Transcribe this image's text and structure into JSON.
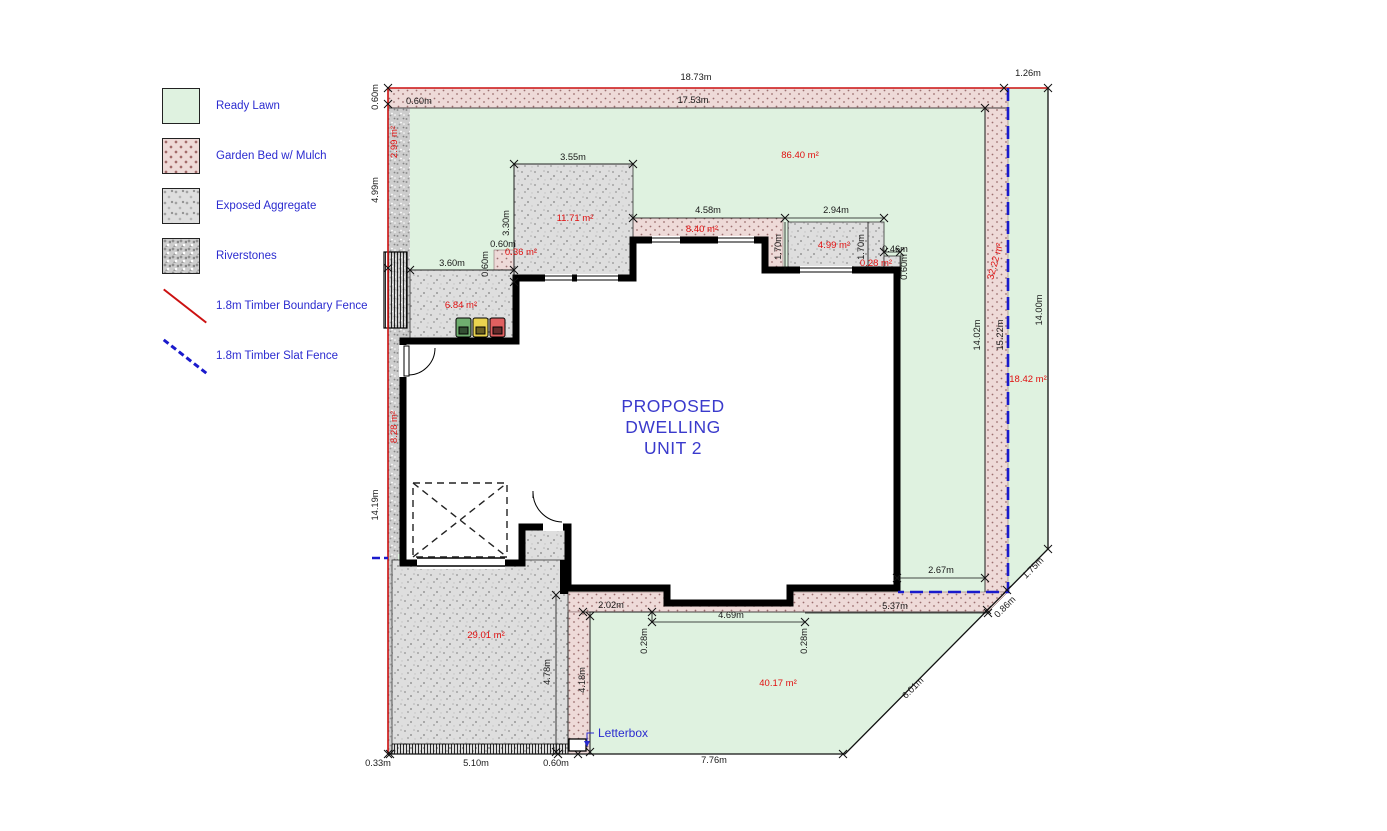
{
  "legend": {
    "items": [
      {
        "swatch": "lawn",
        "label": "Ready Lawn"
      },
      {
        "swatch": "mulch",
        "label": "Garden Bed w/ Mulch"
      },
      {
        "swatch": "aggregate",
        "label": "Exposed Aggregate"
      },
      {
        "swatch": "riverstones",
        "label": "Riverstones"
      },
      {
        "swatch": "red-line",
        "label": "1.8m Timber Boundary Fence"
      },
      {
        "swatch": "blue-dash",
        "label": "1.8m Timber Slat Fence"
      }
    ]
  },
  "title": {
    "line1": "PROPOSED",
    "line2": "DWELLING",
    "line3": "UNIT 2"
  },
  "plan": {
    "letterbox": "Letterbox",
    "dims": {
      "top_total": "18.73m",
      "top_right": "1.26m",
      "top_inner": "17.53m",
      "top_strip_w": "0.60m",
      "left_strip_w": "0.60m",
      "left_upper": "4.99m",
      "left_lower": "14.19m",
      "agg_top": "3.55m",
      "agg_left": "3.30m",
      "bed_small_w": "0.60m",
      "bed_small_h": "0.60m",
      "bin_width": "3.60m",
      "bed_mid": "4.58m",
      "agg_right_w": "2.94m",
      "bed_drop_left": "1.70m",
      "agg_right_h": "1.70m",
      "small_right_w": "0.46m",
      "small_right_h": "0.60m",
      "right_inner": "14.02m",
      "right_fence": "15.22m",
      "right_outer": "14.00m",
      "se_offset": "2.67m",
      "diag_upper": "1.75m",
      "diag_mid": "0.86m",
      "south_strip": "5.37m",
      "south_left": "2.02m",
      "south_mid": "4.69m",
      "south_drop_1": "0.28m",
      "south_drop_2": "0.28m",
      "drive_height": "4.78m",
      "lawn_left_h": "4.18m",
      "bottom_lawn": "7.76m",
      "diag_lower": "6.01m",
      "bottom_margin": "0.33m",
      "bottom_drive": "5.10m",
      "bottom_strip": "0.60m"
    },
    "areas": {
      "strip_top_left": "2.99 m²",
      "lawn_main": "86.40 m²",
      "agg_top": "11.71 m²",
      "bed_mid": "8.40 m²",
      "agg_right": "4.99 m²",
      "agg_small_right": "0.28 m²",
      "bed_small": "0.36 m²",
      "agg_bins": "6.84 m²",
      "strip_left": "8.28 m²",
      "bed_right_strip": "32.22 m²",
      "lawn_right": "18.42 m²",
      "drive": "29.01 m²",
      "lawn_south": "40.17 m²"
    }
  },
  "colors": {
    "lawn": "#dff2e0",
    "mulch": "#eedad8",
    "aggregate": "#dedede",
    "riverstones": "#cdcdcd",
    "boundary_fence": "#cc1111",
    "slat_fence": "#1a1acc",
    "area_text": "#e01010",
    "label_text": "#2b2bd0",
    "dim_text": "#1a1a1a"
  }
}
